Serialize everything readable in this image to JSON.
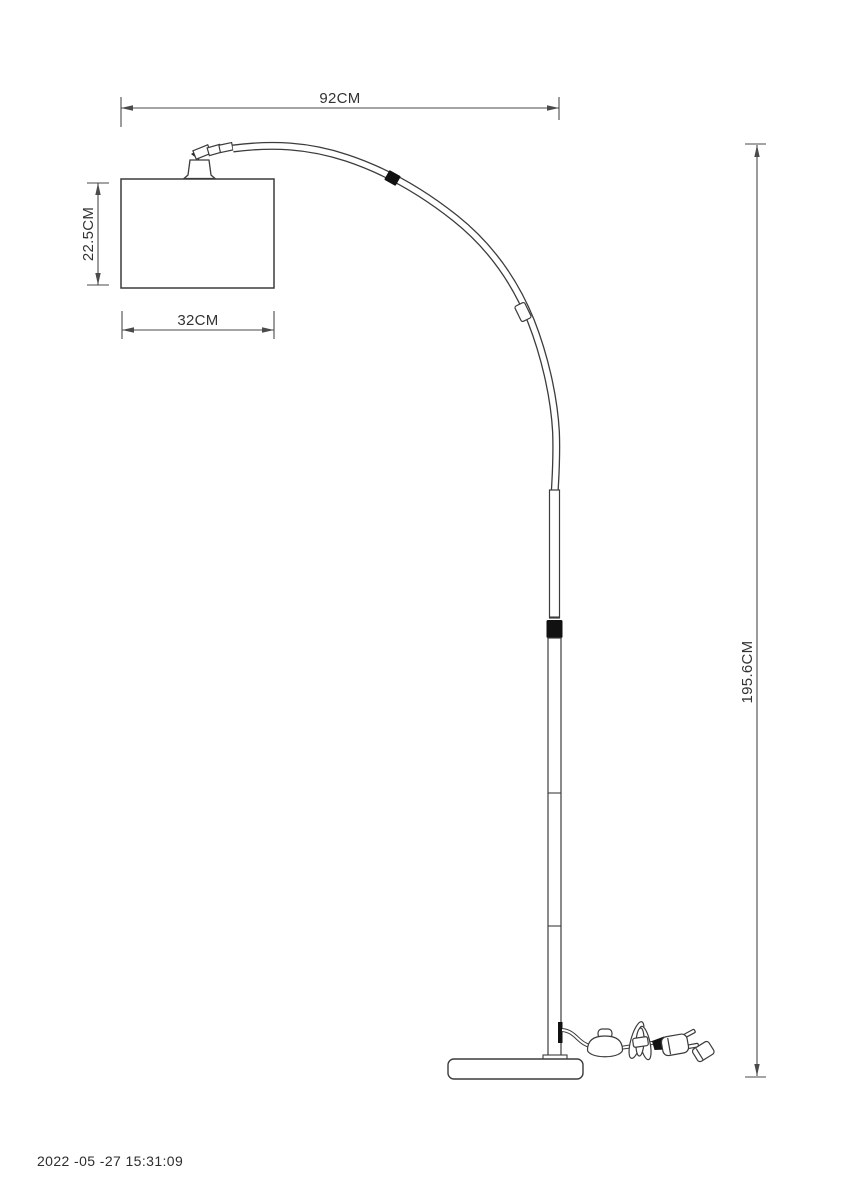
{
  "page": {
    "background": "#ffffff"
  },
  "drawing": {
    "type": "product dimension diagram - arc floor lamp",
    "dimensions": {
      "overall_width": "92CM",
      "shade_height": "22.5CM",
      "shade_width": "32CM",
      "overall_height": "195.6CM"
    },
    "timestamp": "2022 -05 -27 15:31:09",
    "colors": {
      "line": "#3c3c3c",
      "dimension_line": "#4a4a4a",
      "text": "#333333",
      "solid_accent": "#111111",
      "background": "#ffffff"
    }
  }
}
